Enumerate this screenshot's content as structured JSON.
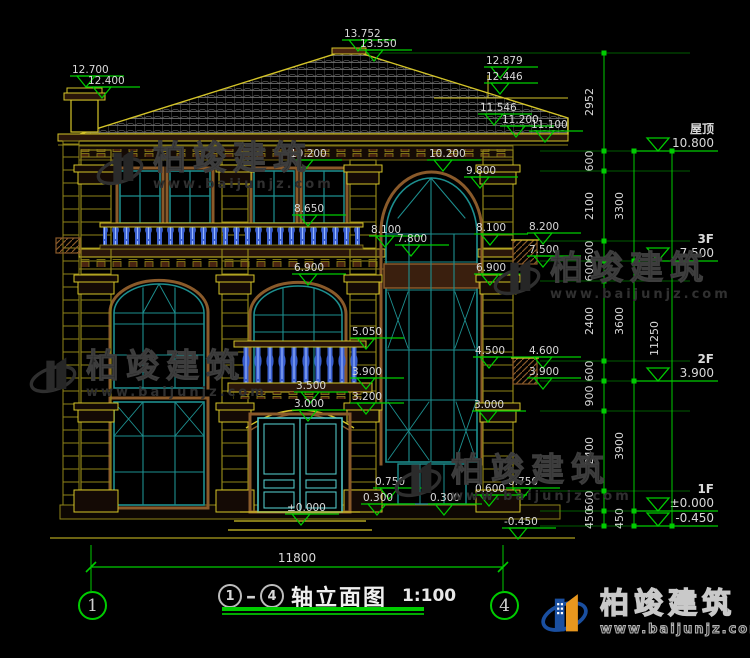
{
  "title_bar": {
    "axis_start": "1",
    "axis_end": "4",
    "title": "轴立面图",
    "scale": "1:100"
  },
  "overall_dim": "11800",
  "floor_markers": [
    {
      "label": "屋顶",
      "value": "10.800",
      "y": 151
    },
    {
      "label": "3F",
      "value": "7.500",
      "y": 261
    },
    {
      "label": "2F",
      "value": "3.900",
      "y": 381
    },
    {
      "label": "1F",
      "value": "±0.000",
      "y": 511
    },
    {
      "label": "",
      "value": "-0.450",
      "y": 526
    }
  ],
  "elevation_markers": [
    {
      "v": "13.752",
      "x": 342,
      "y": 40
    },
    {
      "v": "13.550",
      "x": 358,
      "y": 50
    },
    {
      "v": "12.700",
      "x": 70,
      "y": 76
    },
    {
      "v": "12.400",
      "x": 86,
      "y": 87
    },
    {
      "v": "12.879",
      "x": 484,
      "y": 67
    },
    {
      "v": "12.446",
      "x": 484,
      "y": 83
    },
    {
      "v": "11.546",
      "x": 478,
      "y": 114
    },
    {
      "v": "11.200",
      "x": 500,
      "y": 126
    },
    {
      "v": "11.100",
      "x": 529,
      "y": 131
    },
    {
      "v": "10.200",
      "x": 288,
      "y": 160
    },
    {
      "v": "10.200",
      "x": 427,
      "y": 160
    },
    {
      "v": "9.800",
      "x": 464,
      "y": 177
    },
    {
      "v": "8.650",
      "x": 292,
      "y": 215
    },
    {
      "v": "8.200",
      "x": 527,
      "y": 233
    },
    {
      "v": "8.100",
      "x": 369,
      "y": 236
    },
    {
      "v": "8.100",
      "x": 474,
      "y": 234
    },
    {
      "v": "7.800",
      "x": 395,
      "y": 245
    },
    {
      "v": "7.500",
      "x": 527,
      "y": 256
    },
    {
      "v": "6.900",
      "x": 292,
      "y": 274
    },
    {
      "v": "6.900",
      "x": 474,
      "y": 274
    },
    {
      "v": "5.050",
      "x": 350,
      "y": 338
    },
    {
      "v": "4.600",
      "x": 527,
      "y": 357
    },
    {
      "v": "4.500",
      "x": 473,
      "y": 357
    },
    {
      "v": "3.900",
      "x": 350,
      "y": 378
    },
    {
      "v": "3.900",
      "x": 527,
      "y": 378
    },
    {
      "v": "3.500",
      "x": 294,
      "y": 392
    },
    {
      "v": "3.200",
      "x": 350,
      "y": 403
    },
    {
      "v": "3.000",
      "x": 292,
      "y": 410
    },
    {
      "v": "3.000",
      "x": 472,
      "y": 411
    },
    {
      "v": "0.750",
      "x": 373,
      "y": 488
    },
    {
      "v": "0.750",
      "x": 506,
      "y": 488
    },
    {
      "v": "0.600",
      "x": 473,
      "y": 495
    },
    {
      "v": "0.300",
      "x": 361,
      "y": 504
    },
    {
      "v": "0.300",
      "x": 428,
      "y": 504
    },
    {
      "v": "±0.000",
      "x": 285,
      "y": 514
    },
    {
      "v": "-0.450",
      "x": 502,
      "y": 528
    }
  ],
  "dim_chains": [
    {
      "x": 604,
      "label_x": 593,
      "nodes": [
        53,
        151,
        171,
        241,
        261,
        281,
        361,
        381,
        411,
        491,
        511,
        526
      ],
      "labels": [
        "2952",
        "600",
        "2100",
        "600",
        "600",
        "2400",
        "600",
        "900",
        "2400",
        "600",
        "450"
      ]
    },
    {
      "x": 634,
      "label_x": 623,
      "nodes": [
        151,
        261,
        381,
        511,
        526
      ],
      "labels": [
        "3300",
        "3600",
        "3900",
        "450"
      ]
    },
    {
      "x": 672,
      "label_x": 658,
      "nodes": [
        151,
        526
      ],
      "labels": [
        "11250"
      ]
    }
  ],
  "watermark": {
    "name": "柏竣建筑",
    "url": "www.baijunjz.com"
  },
  "logo": {
    "name": "柏竣建筑",
    "url": "www.baijunjz.com"
  },
  "colors": {
    "dim_green": "#00cc00",
    "trim_yellow": "#d4c428",
    "trim_olive": "#8f8418",
    "wood_brown": "#8a5a2a",
    "window_teal": "#1d8f8f",
    "door_cyan": "#4fc3c3",
    "baluster_blue": "#3a5fd0",
    "text_white": "#d9d9d9"
  }
}
